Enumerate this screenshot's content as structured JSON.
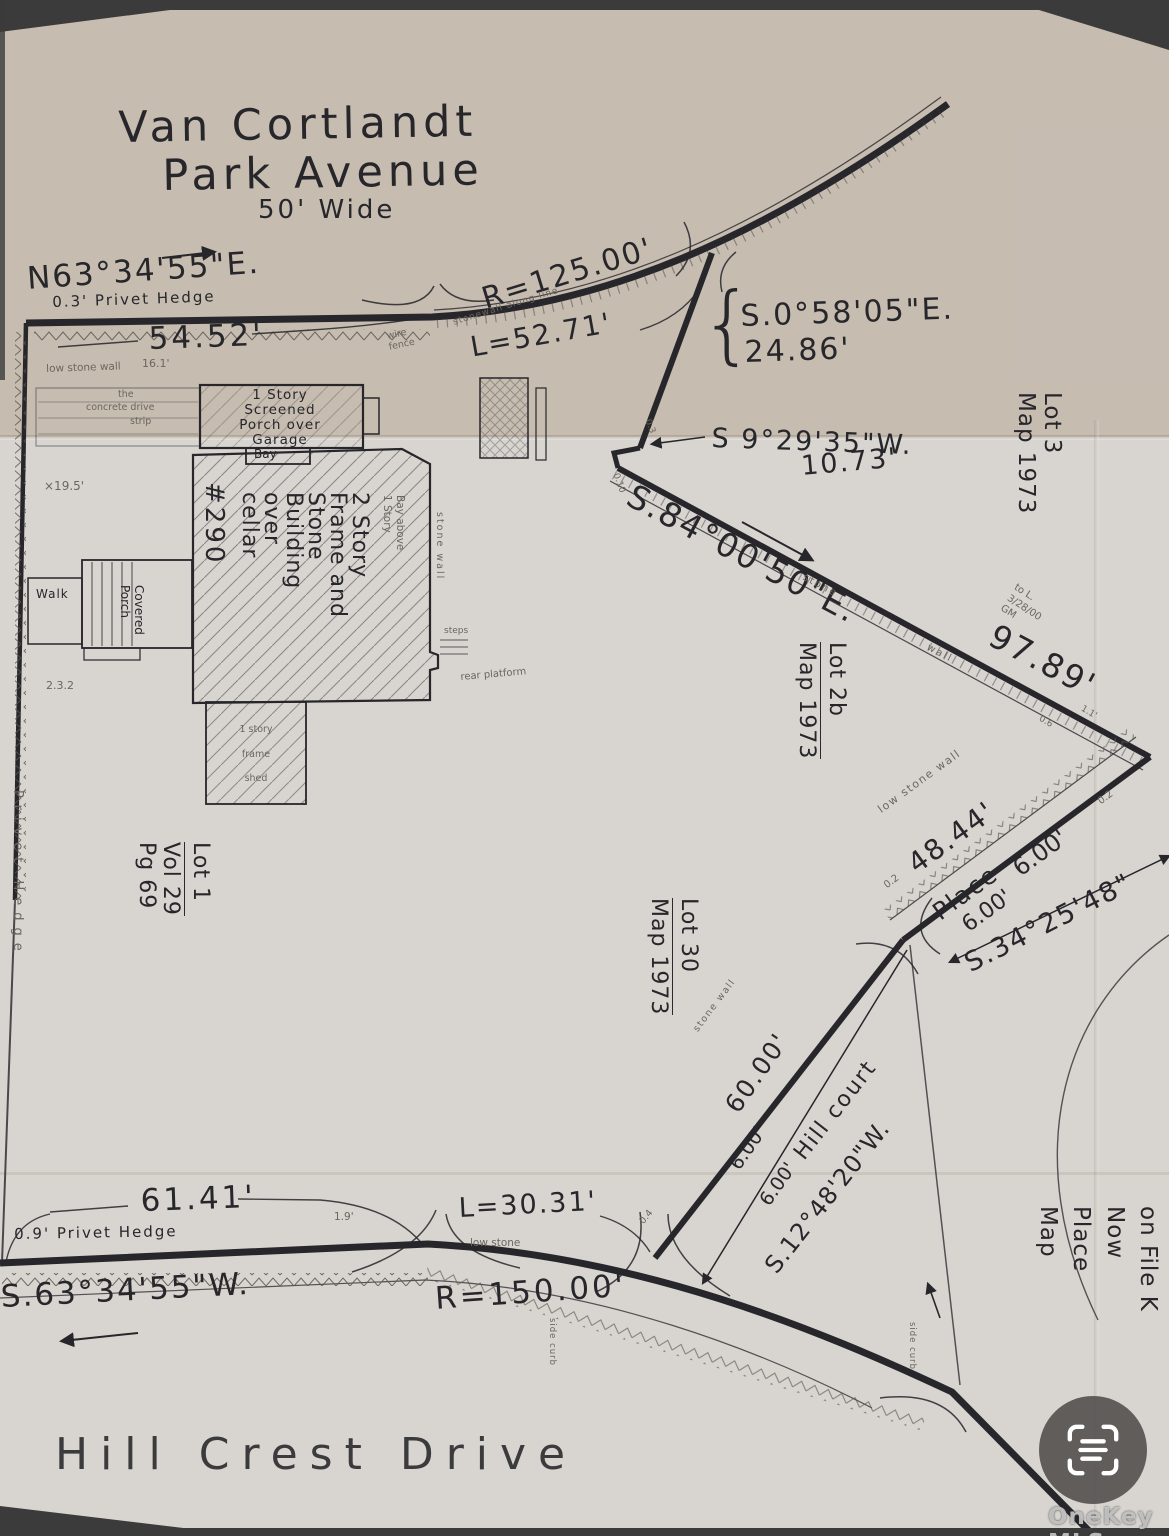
{
  "title": {
    "line1": "Van Cortlandt",
    "line2": "Park Avenue",
    "width_note": "50' Wide"
  },
  "streets": {
    "bottom_name": "Hill Crest Drive",
    "court_name": "Hill court",
    "place_name": "Place"
  },
  "boundaries": {
    "top_bearing": "N63°34'55\"E.",
    "top_hedge": "0.3' Privet Hedge",
    "top_dim": "54.52'",
    "top_dim2": "16.1'",
    "top_wall": "low stone wall",
    "wire_fence_1": "wire",
    "wire_fence_2": "fence",
    "top_radius": "R=125.00'",
    "top_arc": "L=52.71'",
    "top_wall_note": "stonewall along line",
    "east1_bearing": "S.0°58'05\"E.",
    "east1_dist": "24.86'",
    "east2_bearing": "S 9°29'35\"W.",
    "east2_dist": "10.73'",
    "east3_bearing": "S.84°00'50\"E.",
    "east3_dist": "97.89'",
    "east3_wall_1": "stone",
    "east3_wall_2": "wall",
    "off_03": "0.3",
    "off_010": "0.10",
    "off_06": "0.6",
    "off_11": "1.1'",
    "place_wall": "low stone wall",
    "place_dim": "48.44'",
    "place_off1": "0.2",
    "place_off2": "0.2",
    "place_w1": "6.00'",
    "place_w2": "6.00'",
    "se_bearing": "S.34°25'48\"",
    "court_wall": "stone wall",
    "court_dim": "60.00'",
    "court_w1": "6.00'",
    "court_w2": "6.00'",
    "court_bearing": "S.12°48'20\"W.",
    "court_off": "0.4",
    "bottom_dim": "61.41'",
    "bottom_hedge": "0.9' Privet Hedge",
    "bottom_off": "1.9'",
    "bottom_arc": "L=30.31'",
    "bottom_wall": "low stone",
    "bottom_bearing": "S.63°34'55\"W.",
    "bottom_radius": "R=150.00'",
    "left_hedge": "Privet Hedge",
    "curb_note1": "side curb",
    "curb_note2": "side curb"
  },
  "lots": {
    "lot3": [
      "Lot 3",
      "Map 1973"
    ],
    "lot2b": [
      "Lot 2b",
      "Map 1973"
    ],
    "lot1": [
      "Lot 1",
      "Vol 29",
      "Pg 69"
    ],
    "lot30": [
      "Lot 30",
      "Map 1973"
    ],
    "file_note": [
      "on File K",
      "Now",
      "Place",
      "Map"
    ],
    "date_note": [
      "to L.",
      "3/28/00",
      "GM"
    ]
  },
  "house": {
    "number": "#290",
    "main": [
      "2 Story",
      "Frame and",
      "Stone",
      "Building",
      "over",
      "cellar"
    ],
    "garage": [
      "1 Story",
      "Screened",
      "Porch over",
      "Garage"
    ],
    "bay": "Bay",
    "bay_above": [
      "Bay above",
      "1 Story"
    ],
    "porch": [
      "Covered",
      "Porch"
    ],
    "walk": "Walk",
    "side_wall": "stone wall",
    "steps": "steps",
    "rear_platform": "rear platform",
    "shed": [
      "1 story",
      "frame",
      "shed"
    ],
    "dims": {
      "d195": "×19.5'",
      "d232": "2.3.2",
      "conc1": "the",
      "conc2": "concrete drive",
      "conc3": "strip"
    }
  },
  "watermark": {
    "brand": "OneKey MLS",
    "icon": "scan-frame-icon"
  }
}
